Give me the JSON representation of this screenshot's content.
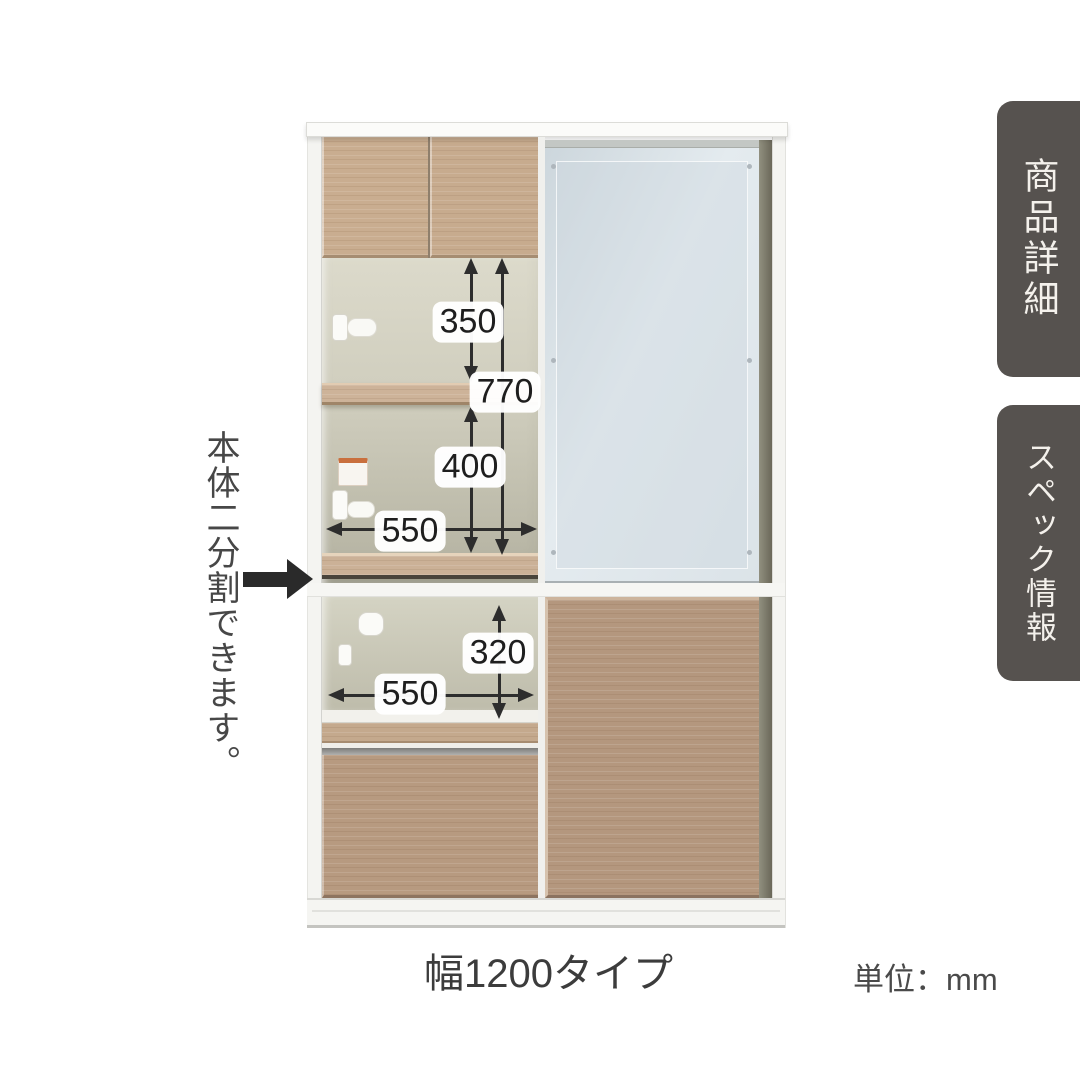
{
  "product_view": {
    "split_note": "本体二分割できます。",
    "width_caption": "幅1200タイプ",
    "unit_caption": "単位：mm",
    "dimensions": {
      "upper_shelf_clearance": "350",
      "upper_total_clearance": "770",
      "upper_lower_clearance": "400",
      "upper_inner_width": "550",
      "lower_clearance": "320",
      "lower_inner_width": "550"
    }
  },
  "side_tabs": [
    {
      "id": "product-details",
      "label": "商品詳細"
    },
    {
      "id": "spec-info",
      "label": "スペック情報"
    }
  ],
  "colors": {
    "tab_background": "#56524f",
    "tab_text": "#f4f1ec",
    "wood_light": "#c9ad90",
    "wood_medium": "#b4977e",
    "glass_blue": "#dde4e9",
    "dimension_ink": "#2d2d2d",
    "annotation_arrow": "#2a2a2a"
  }
}
